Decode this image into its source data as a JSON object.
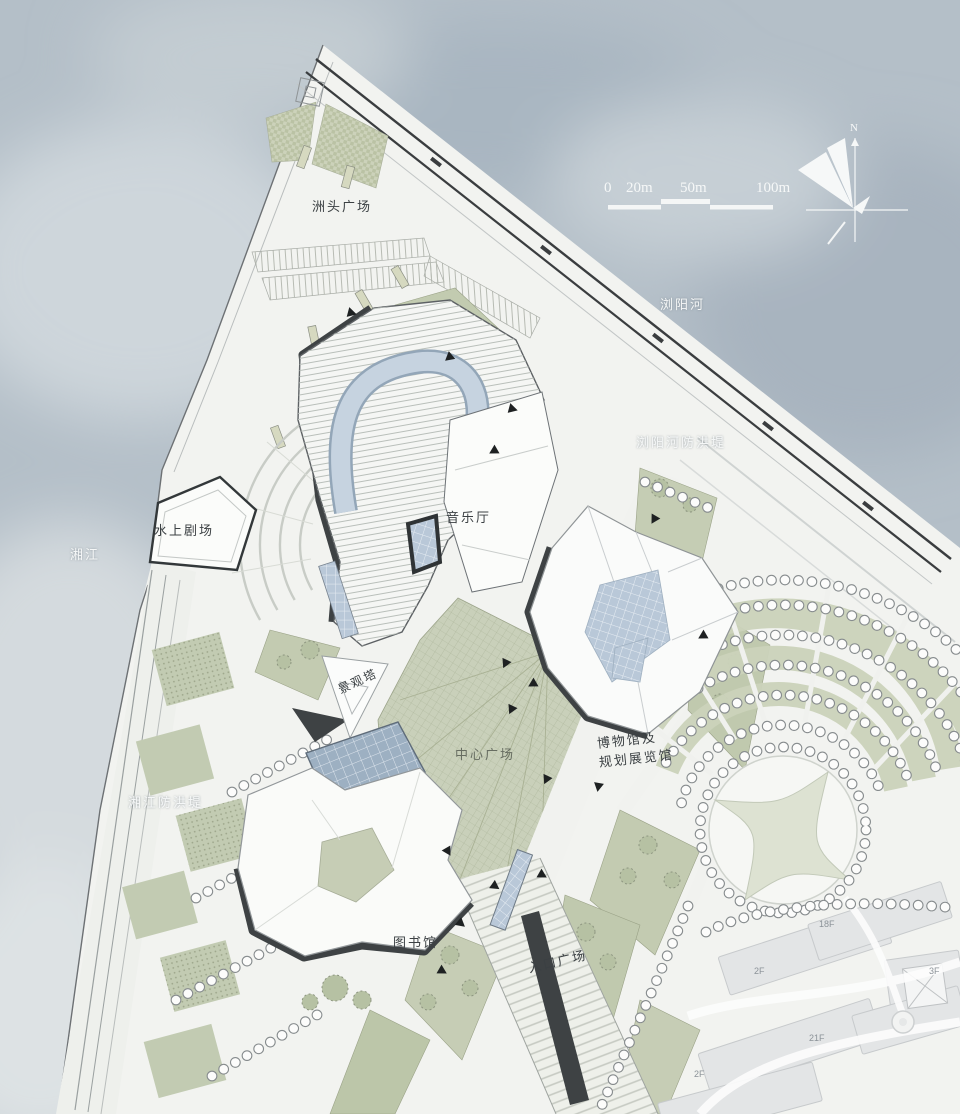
{
  "map": {
    "plan_labels": [
      {
        "id": "zhoutou-square",
        "text": "洲头广场"
      },
      {
        "id": "liuyang-river",
        "text": "浏阳河"
      },
      {
        "id": "liuyang-embankment",
        "text": "浏阳河防洪堤"
      },
      {
        "id": "concert-hall",
        "text": "音乐厅"
      },
      {
        "id": "water-theater",
        "text": "水上剧场"
      },
      {
        "id": "xiang-river",
        "text": "湘江"
      },
      {
        "id": "landscape-tower",
        "text": "景观塔"
      },
      {
        "id": "central-plaza",
        "text": "中心广场"
      },
      {
        "id": "museum-line1",
        "text": "博物馆及"
      },
      {
        "id": "museum-line2",
        "text": "规划展览馆"
      },
      {
        "id": "xiangjiang-embankment",
        "text": "湘江防洪堤"
      },
      {
        "id": "library",
        "text": "图书馆"
      },
      {
        "id": "entrance-plaza",
        "text": "入口广场"
      }
    ],
    "scale_bar": {
      "ticks": [
        "0",
        "20m",
        "50m",
        "100m"
      ]
    },
    "compass": {
      "label": "N"
    },
    "context_floor_labels": [
      "18F",
      "2F",
      "3F",
      "21F",
      "2F"
    ],
    "colors": {
      "water": "#b7c1ca",
      "site": "#f2f3f0",
      "green": "#c5cdb4",
      "glass": "#b9c8d8",
      "shadow": "#3e4244"
    }
  }
}
